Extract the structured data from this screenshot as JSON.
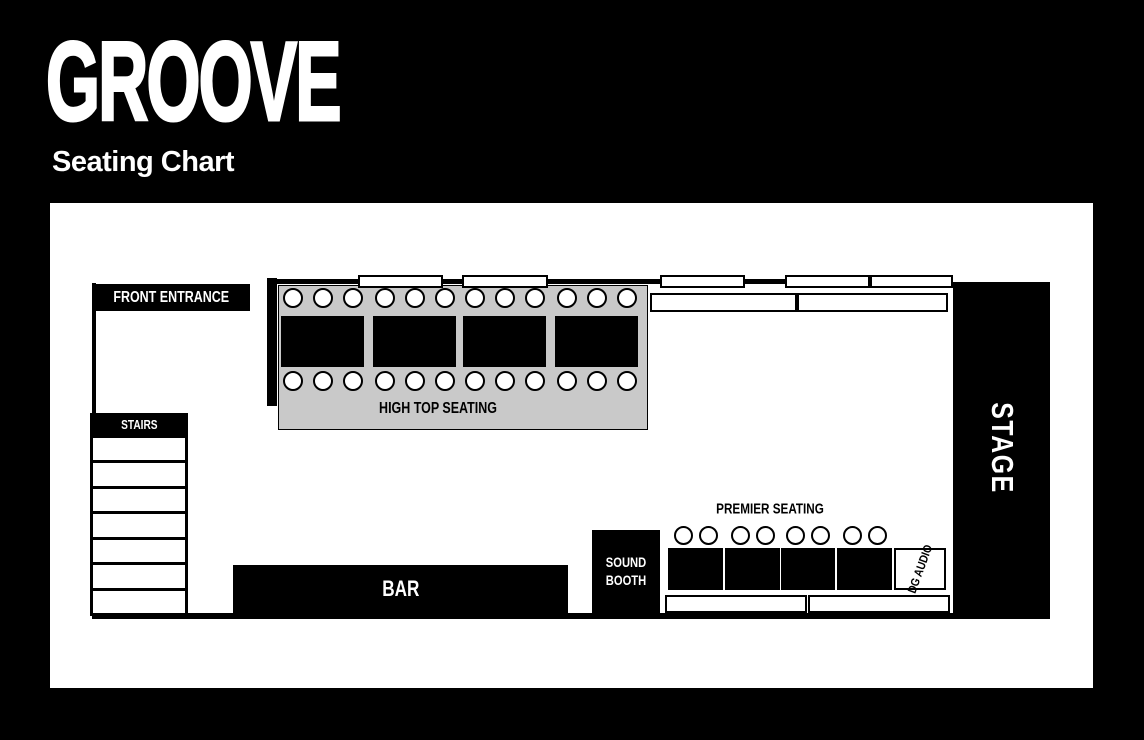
{
  "header": {
    "logo": "GROOVE",
    "subtitle": "Seating Chart"
  },
  "colors": {
    "background": "#000000",
    "floor": "#ffffff",
    "high_top_fill": "#c9c9c9",
    "ink": "#000000",
    "text_light": "#ffffff"
  },
  "floor_plan": {
    "front_entrance": {
      "label": "FRONT ENTRANCE"
    },
    "stairs": {
      "label": "STAIRS",
      "step_count": 7
    },
    "high_top": {
      "label": "HIGH TOP SEATING",
      "table_count": 4,
      "seats_per_table": 6,
      "total_seats": 24
    },
    "stage": {
      "label": "STAGE"
    },
    "bar": {
      "label": "BAR"
    },
    "sound_booth": {
      "label": "SOUND BOOTH"
    },
    "premier": {
      "label": "PREMIER SEATING",
      "table_count": 4,
      "seats_per_table": 2,
      "total_seats": 8
    },
    "dg_audio": {
      "label": "DG AUDIO"
    },
    "wall_window_count": 5,
    "wall_table_count": 2,
    "bench_count": 2
  }
}
